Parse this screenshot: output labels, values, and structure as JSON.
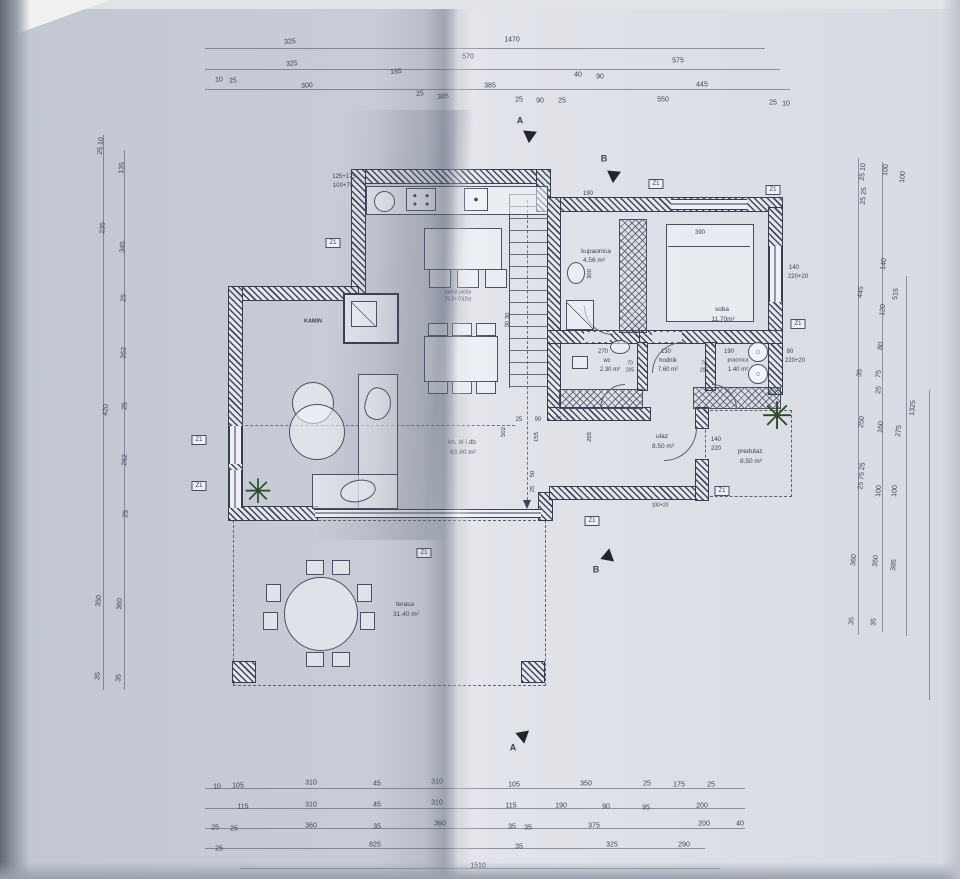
{
  "meta": {
    "drawing_type": "photographed architectural floor plan, ground floor"
  },
  "colors": {
    "paper_left": "#c6cad4",
    "paper_right": "#d9dce3",
    "ink": "#3c4254",
    "plant": "#2c4a24"
  },
  "plan": {
    "window_label": "Z1",
    "window_markers": [
      {
        "x": 333,
        "y": 243
      },
      {
        "x": 656,
        "y": 184
      },
      {
        "x": 773,
        "y": 190
      },
      {
        "x": 798,
        "y": 324
      },
      {
        "x": 199,
        "y": 440
      },
      {
        "x": 199,
        "y": 486
      },
      {
        "x": 424,
        "y": 553
      },
      {
        "x": 592,
        "y": 521
      },
      {
        "x": 722,
        "y": 491
      }
    ],
    "section_arrows": [
      {
        "x": 528,
        "y": 134,
        "rot": 35
      },
      {
        "x": 612,
        "y": 174,
        "rot": 35
      },
      {
        "x": 606,
        "y": 557,
        "rot": -20
      },
      {
        "x": 521,
        "y": 735,
        "rot": 20
      }
    ],
    "labels": [
      {
        "t": "325",
        "x": 290,
        "y": 42,
        "r": -4
      },
      {
        "t": "1470",
        "x": 512,
        "y": 40
      },
      {
        "t": "325",
        "x": 292,
        "y": 64,
        "r": -4
      },
      {
        "t": "570",
        "x": 468,
        "y": 57
      },
      {
        "t": "575",
        "x": 678,
        "y": 61
      },
      {
        "t": "185",
        "x": 396,
        "y": 72,
        "r": -4
      },
      {
        "t": "385",
        "x": 490,
        "y": 86
      },
      {
        "t": "40",
        "x": 578,
        "y": 75
      },
      {
        "t": "90",
        "x": 600,
        "y": 77
      },
      {
        "t": "445",
        "x": 702,
        "y": 85
      },
      {
        "t": "10",
        "x": 219,
        "y": 80,
        "r": -4
      },
      {
        "t": "25",
        "x": 233,
        "y": 81,
        "r": -4
      },
      {
        "t": "300",
        "x": 307,
        "y": 86,
        "r": -4
      },
      {
        "t": "25",
        "x": 420,
        "y": 94,
        "r": -4
      },
      {
        "t": "385",
        "x": 443,
        "y": 97,
        "r": -4
      },
      {
        "t": "25",
        "x": 519,
        "y": 100
      },
      {
        "t": "90",
        "x": 540,
        "y": 101
      },
      {
        "t": "25",
        "x": 562,
        "y": 101
      },
      {
        "t": "550",
        "x": 663,
        "y": 100
      },
      {
        "t": "25",
        "x": 773,
        "y": 103
      },
      {
        "t": "10",
        "x": 786,
        "y": 104
      },
      {
        "t": "A",
        "x": 520,
        "y": 121,
        "s": 9,
        "b": 1,
        "n": "section-label-a-top"
      },
      {
        "t": "B",
        "x": 604,
        "y": 159,
        "s": 9,
        "b": 1,
        "n": "section-label-b-top"
      },
      {
        "t": "B",
        "x": 596,
        "y": 570,
        "s": 9,
        "b": 1,
        "n": "section-label-b-mid"
      },
      {
        "t": "A",
        "x": 513,
        "y": 748,
        "s": 9,
        "b": 1,
        "n": "section-label-a-bottom"
      },
      {
        "t": "25 10",
        "x": 101,
        "y": 146,
        "r": -86
      },
      {
        "t": "235",
        "x": 103,
        "y": 228,
        "r": -86
      },
      {
        "t": "420",
        "x": 106,
        "y": 410,
        "r": -86
      },
      {
        "t": "350",
        "x": 99,
        "y": 601,
        "r": -86
      },
      {
        "t": "35",
        "x": 98,
        "y": 676,
        "r": -86
      },
      {
        "t": "135",
        "x": 122,
        "y": 168,
        "r": -86
      },
      {
        "t": "345",
        "x": 123,
        "y": 247,
        "r": -86
      },
      {
        "t": "25",
        "x": 124,
        "y": 298,
        "r": -86
      },
      {
        "t": "262",
        "x": 124,
        "y": 353,
        "r": -86
      },
      {
        "t": "25",
        "x": 125,
        "y": 406,
        "r": -86
      },
      {
        "t": "262",
        "x": 125,
        "y": 460,
        "r": -86
      },
      {
        "t": "25",
        "x": 126,
        "y": 514,
        "r": -86
      },
      {
        "t": "360",
        "x": 120,
        "y": 604,
        "r": -86
      },
      {
        "t": "35",
        "x": 119,
        "y": 678,
        "r": -86
      },
      {
        "t": "25 10",
        "x": 863,
        "y": 172,
        "r": -85
      },
      {
        "t": "25 25",
        "x": 864,
        "y": 196,
        "r": -85
      },
      {
        "t": "100",
        "x": 886,
        "y": 170,
        "r": -85
      },
      {
        "t": "100",
        "x": 903,
        "y": 177,
        "r": -85
      },
      {
        "t": "140",
        "x": 884,
        "y": 264,
        "r": -85
      },
      {
        "t": "445",
        "x": 861,
        "y": 292,
        "r": -85
      },
      {
        "t": "515",
        "x": 896,
        "y": 294,
        "r": -85
      },
      {
        "t": "120",
        "x": 883,
        "y": 310,
        "r": -85
      },
      {
        "t": "80",
        "x": 881,
        "y": 346,
        "r": -85
      },
      {
        "t": "35",
        "x": 860,
        "y": 373,
        "r": -85
      },
      {
        "t": "75",
        "x": 879,
        "y": 374,
        "r": -85
      },
      {
        "t": "25",
        "x": 879,
        "y": 390,
        "r": -85
      },
      {
        "t": "250",
        "x": 862,
        "y": 422,
        "r": -85
      },
      {
        "t": "160",
        "x": 881,
        "y": 427,
        "r": -85
      },
      {
        "t": "275",
        "x": 899,
        "y": 431,
        "r": -85
      },
      {
        "t": "1325",
        "x": 913,
        "y": 408,
        "r": -85
      },
      {
        "t": "25 75 25",
        "x": 862,
        "y": 476,
        "r": -85
      },
      {
        "t": "100",
        "x": 879,
        "y": 491,
        "r": -85
      },
      {
        "t": "100",
        "x": 895,
        "y": 491,
        "r": -85
      },
      {
        "t": "360",
        "x": 854,
        "y": 560,
        "r": -85
      },
      {
        "t": "350",
        "x": 876,
        "y": 561,
        "r": -85
      },
      {
        "t": "385",
        "x": 894,
        "y": 565,
        "r": -85
      },
      {
        "t": "35",
        "x": 852,
        "y": 621,
        "r": -85
      },
      {
        "t": "35",
        "x": 874,
        "y": 622,
        "r": -85
      },
      {
        "t": "10",
        "x": 217,
        "y": 787
      },
      {
        "t": "105",
        "x": 238,
        "y": 786
      },
      {
        "t": "310",
        "x": 311,
        "y": 783
      },
      {
        "t": "45",
        "x": 377,
        "y": 784
      },
      {
        "t": "310",
        "x": 437,
        "y": 782
      },
      {
        "t": "105",
        "x": 514,
        "y": 785
      },
      {
        "t": "350",
        "x": 586,
        "y": 784
      },
      {
        "t": "25",
        "x": 647,
        "y": 784
      },
      {
        "t": "175",
        "x": 679,
        "y": 785
      },
      {
        "t": "25",
        "x": 711,
        "y": 785
      },
      {
        "t": "115",
        "x": 243,
        "y": 807
      },
      {
        "t": "310",
        "x": 311,
        "y": 805
      },
      {
        "t": "45",
        "x": 377,
        "y": 805
      },
      {
        "t": "310",
        "x": 437,
        "y": 803
      },
      {
        "t": "115",
        "x": 511,
        "y": 806
      },
      {
        "t": "190",
        "x": 561,
        "y": 806
      },
      {
        "t": "90",
        "x": 606,
        "y": 807
      },
      {
        "t": "95",
        "x": 646,
        "y": 808
      },
      {
        "t": "200",
        "x": 702,
        "y": 806
      },
      {
        "t": "25",
        "x": 215,
        "y": 828
      },
      {
        "t": "25",
        "x": 234,
        "y": 829
      },
      {
        "t": "360",
        "x": 311,
        "y": 826
      },
      {
        "t": "35",
        "x": 377,
        "y": 827
      },
      {
        "t": "360",
        "x": 440,
        "y": 824
      },
      {
        "t": "35",
        "x": 512,
        "y": 827
      },
      {
        "t": "35",
        "x": 528,
        "y": 828
      },
      {
        "t": "375",
        "x": 594,
        "y": 826
      },
      {
        "t": "200",
        "x": 704,
        "y": 824
      },
      {
        "t": "40",
        "x": 740,
        "y": 824
      },
      {
        "t": "25",
        "x": 219,
        "y": 849
      },
      {
        "t": "825",
        "x": 375,
        "y": 845
      },
      {
        "t": "35",
        "x": 519,
        "y": 847
      },
      {
        "t": "325",
        "x": 612,
        "y": 845
      },
      {
        "t": "290",
        "x": 684,
        "y": 845
      },
      {
        "t": "1510",
        "x": 478,
        "y": 866
      },
      {
        "t": "125+175",
        "x": 344,
        "y": 177,
        "s": 6
      },
      {
        "t": "100+75",
        "x": 343,
        "y": 186,
        "s": 6
      },
      {
        "t": "190",
        "x": 588,
        "y": 194,
        "s": 6
      },
      {
        "t": "390",
        "x": 700,
        "y": 233,
        "s": 6
      },
      {
        "t": "300",
        "x": 590,
        "y": 274,
        "r": -88,
        "s": 6
      },
      {
        "t": "30 30",
        "x": 508,
        "y": 320,
        "r": -88,
        "s": 6
      },
      {
        "t": "270",
        "x": 603,
        "y": 352,
        "s": 6
      },
      {
        "t": "130",
        "x": 666,
        "y": 352,
        "s": 6
      },
      {
        "t": "190",
        "x": 729,
        "y": 352,
        "s": 6
      },
      {
        "t": "70",
        "x": 630,
        "y": 364,
        "s": 5
      },
      {
        "t": "205",
        "x": 630,
        "y": 371,
        "s": 5
      },
      {
        "t": "70",
        "x": 704,
        "y": 364,
        "s": 5
      },
      {
        "t": "205",
        "x": 704,
        "y": 371,
        "s": 5
      },
      {
        "t": "502",
        "x": 504,
        "y": 432,
        "r": -88,
        "s": 6
      },
      {
        "t": "25",
        "x": 519,
        "y": 420,
        "s": 6
      },
      {
        "t": "90",
        "x": 538,
        "y": 420,
        "s": 6
      },
      {
        "t": "25",
        "x": 558,
        "y": 420,
        "s": 6
      },
      {
        "t": "155",
        "x": 537,
        "y": 437,
        "r": -88,
        "s": 6
      },
      {
        "t": "265",
        "x": 590,
        "y": 437,
        "r": -88,
        "s": 6
      },
      {
        "t": "50",
        "x": 533,
        "y": 474,
        "r": -88,
        "s": 6
      },
      {
        "t": "25",
        "x": 533,
        "y": 489,
        "r": -88,
        "s": 6
      },
      {
        "t": "140",
        "x": 716,
        "y": 440,
        "s": 6
      },
      {
        "t": "220",
        "x": 716,
        "y": 449,
        "s": 6
      },
      {
        "t": "140",
        "x": 794,
        "y": 268,
        "s": 6
      },
      {
        "t": "220+20",
        "x": 798,
        "y": 277,
        "s": 6
      },
      {
        "t": "80",
        "x": 790,
        "y": 352,
        "s": 6
      },
      {
        "t": "220+20",
        "x": 795,
        "y": 361,
        "s": 6
      },
      {
        "t": "100+20",
        "x": 660,
        "y": 506,
        "s": 5
      },
      {
        "t": "kupaonica",
        "x": 596,
        "y": 252,
        "s": 6.5,
        "n": "room-label-kupaonica"
      },
      {
        "t": "4.56 m²",
        "x": 594,
        "y": 261,
        "s": 6.5
      },
      {
        "t": "soba",
        "x": 722,
        "y": 310,
        "s": 6.5,
        "n": "room-label-soba"
      },
      {
        "t": "11.70m²",
        "x": 723,
        "y": 320,
        "s": 6.5
      },
      {
        "t": "wc",
        "x": 607,
        "y": 361,
        "s": 6,
        "n": "room-label-wc"
      },
      {
        "t": "2.30 m²",
        "x": 610,
        "y": 370,
        "s": 6
      },
      {
        "t": "hodnik",
        "x": 668,
        "y": 361,
        "s": 6,
        "n": "room-label-hodnik"
      },
      {
        "t": "7.60 m²",
        "x": 668,
        "y": 370,
        "s": 6
      },
      {
        "t": "praonica",
        "x": 738,
        "y": 361,
        "s": 5.5,
        "n": "room-label-praonica"
      },
      {
        "t": "1.40 m²",
        "x": 738,
        "y": 370,
        "s": 6
      },
      {
        "t": "ulaz",
        "x": 662,
        "y": 437,
        "s": 6.5,
        "n": "room-label-ulaz"
      },
      {
        "t": "8.50 m²",
        "x": 663,
        "y": 447,
        "s": 6.5
      },
      {
        "t": "predulaz",
        "x": 750,
        "y": 452,
        "s": 6.5,
        "n": "room-label-predulaz"
      },
      {
        "t": "8.50 m²",
        "x": 751,
        "y": 462,
        "s": 6.5
      },
      {
        "t": "kh, bl i db",
        "x": 462,
        "y": 443,
        "s": 6.5,
        "n": "room-label-living"
      },
      {
        "t": "63.80 m²",
        "x": 463,
        "y": 453,
        "s": 6.5
      },
      {
        "t": "terasa",
        "x": 405,
        "y": 605,
        "s": 6.5,
        "n": "room-label-terasa"
      },
      {
        "t": "31.40 m²",
        "x": 406,
        "y": 615,
        "s": 6.5
      },
      {
        "t": "KAMIN",
        "x": 313,
        "y": 322,
        "s": 5.5,
        "b": 1,
        "n": "fireplace-label"
      },
      {
        "t": "radna ploča",
        "x": 458,
        "y": 293,
        "s": 5
      },
      {
        "t": "70.5+70(2x)",
        "x": 458,
        "y": 300,
        "s": 5
      },
      {
        "t": "✳",
        "x": 258,
        "y": 492,
        "s": 34,
        "c": "#2c4a24",
        "n": "plant-icon"
      },
      {
        "t": "✳",
        "x": 777,
        "y": 417,
        "s": 38,
        "c": "#2c4a24",
        "n": "plant-icon"
      }
    ]
  }
}
